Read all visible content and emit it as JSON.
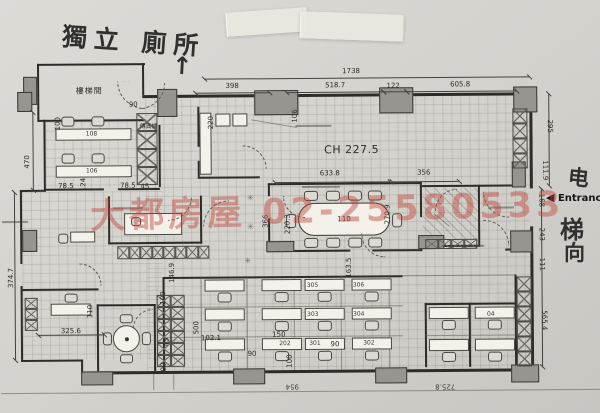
{
  "handwriting": {
    "toilet_note": "獨立 廁所",
    "elevator": [
      "电",
      "梯",
      "向"
    ]
  },
  "icons": {
    "up_arrow": "↑",
    "entrance_arrow": "◀",
    "plant": "✳"
  },
  "entrance": {
    "label": "Entrance"
  },
  "watermark": {
    "text": "大都房屋 02-25580533",
    "color": "#be4437"
  },
  "plan": {
    "ceiling_height": "CH 227.5",
    "rooms": {
      "stairwell": "樓梯間",
      "fax_machine": "傳真機"
    },
    "overall_width": "1738",
    "labels": [
      {
        "t": "1738",
        "x": 352,
        "y": 72
      },
      {
        "t": "398",
        "x": 233,
        "y": 86
      },
      {
        "t": "518.7",
        "x": 336,
        "y": 86
      },
      {
        "t": "122",
        "x": 394,
        "y": 87
      },
      {
        "t": "605.8",
        "x": 461,
        "y": 86
      },
      {
        "t": "295",
        "x": 550,
        "y": 128,
        "r": 90
      },
      {
        "t": "111.9",
        "x": 545,
        "y": 172,
        "r": 90
      },
      {
        "t": "168",
        "x": 541,
        "y": 202,
        "r": 90
      },
      {
        "t": "243",
        "x": 541,
        "y": 236,
        "r": 90
      },
      {
        "t": "111",
        "x": 541,
        "y": 266,
        "r": 90
      },
      {
        "t": "565.4",
        "x": 543,
        "y": 322,
        "r": 90
      },
      {
        "t": "470",
        "x": 28,
        "y": 160,
        "r": -90
      },
      {
        "t": "374.7",
        "x": 11,
        "y": 276,
        "r": -90
      },
      {
        "t": "90",
        "x": 134,
        "y": 104
      },
      {
        "t": "100",
        "x": 59,
        "y": 122,
        "r": -90
      },
      {
        "t": "78.5",
        "x": 66,
        "y": 185
      },
      {
        "t": "124",
        "x": 84,
        "y": 183,
        "r": -90
      },
      {
        "t": "78.5",
        "x": 128,
        "y": 185
      },
      {
        "t": "45",
        "x": 145,
        "y": 186
      },
      {
        "t": "220",
        "x": 212,
        "y": 122,
        "r": -90
      },
      {
        "t": "106",
        "x": 296,
        "y": 116,
        "r": -90
      },
      {
        "t": "CH 227.5",
        "x": 352,
        "y": 150,
        "c": "ch"
      },
      {
        "t": "633.8",
        "x": 330,
        "y": 174
      },
      {
        "t": "356",
        "x": 424,
        "y": 174
      },
      {
        "t": "366",
        "x": 266,
        "y": 221,
        "r": -90
      },
      {
        "t": "220.3",
        "x": 288,
        "y": 224,
        "r": -90
      },
      {
        "t": "270.9",
        "x": 388,
        "y": 215,
        "r": -90
      },
      {
        "t": "163.5",
        "x": 349,
        "y": 268,
        "r": -90
      },
      {
        "t": "146.9",
        "x": 172,
        "y": 272,
        "r": -90
      },
      {
        "t": "100",
        "x": 163,
        "y": 297,
        "r": -90
      },
      {
        "t": "110",
        "x": 90,
        "y": 310,
        "r": -90
      },
      {
        "t": "325.6",
        "x": 70,
        "y": 330
      },
      {
        "t": "500",
        "x": 196,
        "y": 327,
        "r": -90
      },
      {
        "t": "45",
        "x": 166,
        "y": 341,
        "r": -90
      },
      {
        "t": "90",
        "x": 163,
        "y": 366,
        "r": -90
      },
      {
        "t": "102.1",
        "x": 210,
        "y": 338
      },
      {
        "t": "150",
        "x": 278,
        "y": 335
      },
      {
        "t": "90",
        "x": 251,
        "y": 354
      },
      {
        "t": "100",
        "x": 289,
        "y": 361,
        "r": -90
      },
      {
        "t": "90",
        "x": 334,
        "y": 345
      },
      {
        "t": "110",
        "x": 344,
        "y": 220,
        "c": "tbl"
      },
      {
        "t": "305",
        "x": 312,
        "y": 286,
        "c": "no"
      },
      {
        "t": "306",
        "x": 358,
        "y": 286,
        "c": "no"
      },
      {
        "t": "303",
        "x": 312,
        "y": 315,
        "c": "no"
      },
      {
        "t": "304",
        "x": 358,
        "y": 315,
        "c": "no"
      },
      {
        "t": "202",
        "x": 284,
        "y": 344,
        "c": "no"
      },
      {
        "t": "301",
        "x": 314,
        "y": 344,
        "c": "no"
      },
      {
        "t": "302",
        "x": 368,
        "y": 344,
        "c": "no"
      },
      {
        "t": "04",
        "x": 490,
        "y": 316,
        "c": "no"
      },
      {
        "t": "108",
        "x": 92,
        "y": 133,
        "c": "no"
      },
      {
        "t": "106",
        "x": 92,
        "y": 170,
        "c": "no"
      },
      {
        "t": "954",
        "x": 291,
        "y": 386,
        "r": 180,
        "c": "flip"
      },
      {
        "t": "725.8",
        "x": 444,
        "y": 387,
        "r": 180,
        "c": "flip"
      },
      {
        "t": "樓梯間",
        "x": 90,
        "y": 90,
        "c": "room"
      },
      {
        "t": "傳真機",
        "x": 149,
        "y": 126,
        "c": "fax"
      }
    ]
  }
}
